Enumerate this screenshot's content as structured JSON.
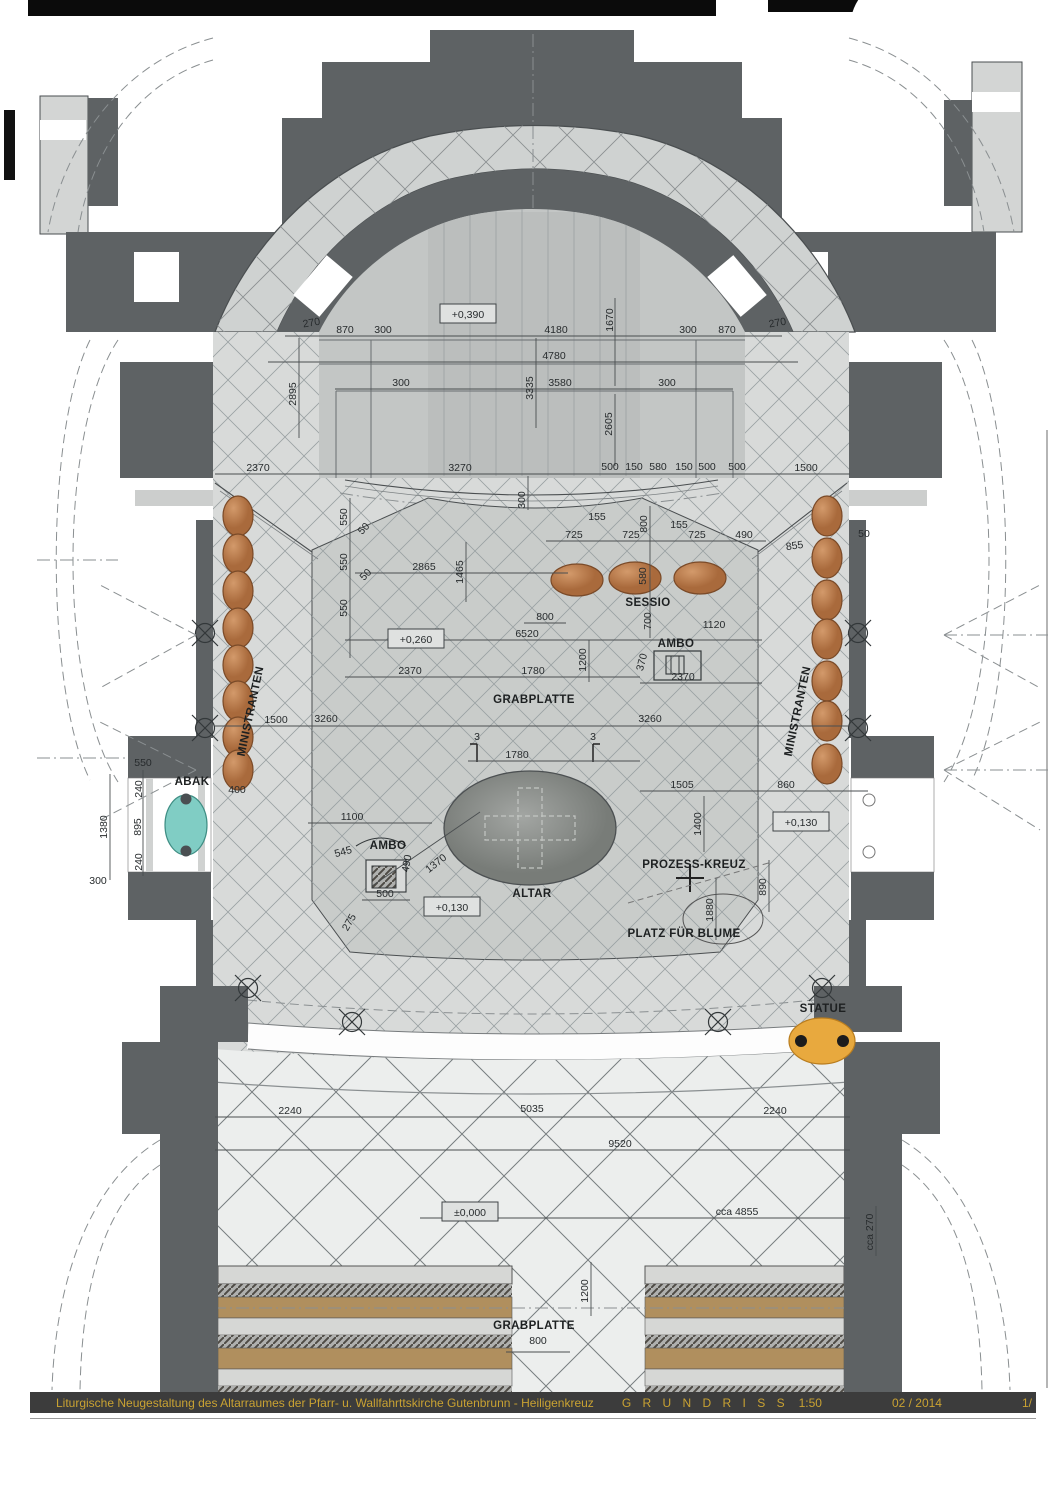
{
  "title_bar": {
    "project": "Liturgische Neugestaltung des Altarraumes der Pfarr- u. Wallfahrttskirche Gutenbrunn - Heiligenkreuz",
    "drawing": "G R U N D R I S S",
    "scale": "1:50",
    "date": "02 / 2014",
    "page": "1/"
  },
  "colors": {
    "wall": "#5e6264",
    "floor": "#d8dad9",
    "floor_nave": "#eceeed",
    "platform": "#c9ccca",
    "apse_floor": "#c3c6c5",
    "band": "#cfd2d1",
    "grid_line": "#9aa1a3",
    "seat": "#c08456",
    "seat_dark": "#7a4a28",
    "abak": "#80cdc4",
    "statue": "#e8a93e",
    "altar": "#8d908d",
    "pew_wood": "#b08f5e",
    "pew_light": "#d6d7d5",
    "pew_hatch": "#b0b1af",
    "title_bg": "#3c3c3c",
    "title_text": "#c9a232",
    "dash": "#8a8f91",
    "line": "#4a4e50"
  },
  "feature_labels": [
    {
      "t": "MINISTRANTEN",
      "x": 254,
      "y": 712,
      "r": -78
    },
    {
      "t": "MINISTRANTEN",
      "x": 801,
      "y": 712,
      "r": -78
    },
    {
      "t": "SESSIO",
      "x": 648,
      "y": 606
    },
    {
      "t": "AMBO",
      "x": 676,
      "y": 647
    },
    {
      "t": "AMBO",
      "x": 388,
      "y": 849
    },
    {
      "t": "GRABPLATTE",
      "x": 534,
      "y": 703
    },
    {
      "t": "ALTAR",
      "x": 532,
      "y": 897
    },
    {
      "t": "PROZESS-KREUZ",
      "x": 694,
      "y": 868
    },
    {
      "t": "PLATZ FÜR BLUME",
      "x": 684,
      "y": 937
    },
    {
      "t": "ABAK",
      "x": 192,
      "y": 785
    },
    {
      "t": "STATUE",
      "x": 823,
      "y": 1012
    },
    {
      "t": "GRABPLATTE",
      "x": 534,
      "y": 1329
    }
  ],
  "elevations": [
    {
      "t": "+0,390",
      "x": 468,
      "y": 314
    },
    {
      "t": "+0,260",
      "x": 416,
      "y": 639
    },
    {
      "t": "+0,130",
      "x": 452,
      "y": 907
    },
    {
      "t": "+0,130",
      "x": 801,
      "y": 822
    },
    {
      "t": "±0,000",
      "x": 470,
      "y": 1212
    }
  ],
  "dimensions": [
    {
      "t": "270",
      "x": 312,
      "y": 326,
      "r": -10
    },
    {
      "t": "870",
      "x": 345,
      "y": 333
    },
    {
      "t": "300",
      "x": 383,
      "y": 333
    },
    {
      "t": "4180",
      "x": 556,
      "y": 333
    },
    {
      "t": "1670",
      "x": 613,
      "y": 320,
      "r": -90
    },
    {
      "t": "300",
      "x": 688,
      "y": 333
    },
    {
      "t": "870",
      "x": 727,
      "y": 333
    },
    {
      "t": "270",
      "x": 778,
      "y": 326,
      "r": -10
    },
    {
      "t": "4780",
      "x": 554,
      "y": 359
    },
    {
      "t": "2895",
      "x": 296,
      "y": 394,
      "r": -90
    },
    {
      "t": "3335",
      "x": 533,
      "y": 388,
      "r": -90
    },
    {
      "t": "3580",
      "x": 560,
      "y": 386
    },
    {
      "t": "300",
      "x": 401,
      "y": 386
    },
    {
      "t": "300",
      "x": 667,
      "y": 386
    },
    {
      "t": "2605",
      "x": 612,
      "y": 424,
      "r": -90
    },
    {
      "t": "2370",
      "x": 258,
      "y": 471
    },
    {
      "t": "3270",
      "x": 460,
      "y": 471
    },
    {
      "t": "500",
      "x": 610,
      "y": 470
    },
    {
      "t": "150",
      "x": 634,
      "y": 470
    },
    {
      "t": "580",
      "x": 658,
      "y": 470
    },
    {
      "t": "150",
      "x": 684,
      "y": 470
    },
    {
      "t": "500",
      "x": 707,
      "y": 470
    },
    {
      "t": "500",
      "x": 737,
      "y": 470
    },
    {
      "t": "1500",
      "x": 806,
      "y": 471
    },
    {
      "t": "300",
      "x": 525,
      "y": 500,
      "r": -90
    },
    {
      "t": "550",
      "x": 347,
      "y": 517,
      "r": -90
    },
    {
      "t": "50",
      "x": 366,
      "y": 531,
      "r": -45
    },
    {
      "t": "550",
      "x": 347,
      "y": 562,
      "r": -90
    },
    {
      "t": "50",
      "x": 368,
      "y": 577,
      "r": -45
    },
    {
      "t": "550",
      "x": 347,
      "y": 608,
      "r": -90
    },
    {
      "t": "2865",
      "x": 424,
      "y": 570
    },
    {
      "t": "1500",
      "x": 276,
      "y": 723
    },
    {
      "t": "400",
      "x": 237,
      "y": 793
    },
    {
      "t": "155",
      "x": 597,
      "y": 520
    },
    {
      "t": "725",
      "x": 574,
      "y": 538
    },
    {
      "t": "725",
      "x": 631,
      "y": 538
    },
    {
      "t": "155",
      "x": 679,
      "y": 528
    },
    {
      "t": "725",
      "x": 697,
      "y": 538
    },
    {
      "t": "490",
      "x": 744,
      "y": 538
    },
    {
      "t": "855",
      "x": 795,
      "y": 549,
      "r": -8
    },
    {
      "t": "50",
      "x": 864,
      "y": 537
    },
    {
      "t": "1465",
      "x": 463,
      "y": 572,
      "r": -90
    },
    {
      "t": "800",
      "x": 647,
      "y": 524,
      "r": -90
    },
    {
      "t": "580",
      "x": 646,
      "y": 576,
      "r": -90
    },
    {
      "t": "700",
      "x": 651,
      "y": 621,
      "r": -90
    },
    {
      "t": "800",
      "x": 545,
      "y": 620
    },
    {
      "t": "6520",
      "x": 527,
      "y": 637
    },
    {
      "t": "1200",
      "x": 586,
      "y": 660,
      "r": -90
    },
    {
      "t": "1120",
      "x": 714,
      "y": 628
    },
    {
      "t": "370",
      "x": 645,
      "y": 663,
      "r": -75
    },
    {
      "t": "2370",
      "x": 410,
      "y": 674
    },
    {
      "t": "1780",
      "x": 533,
      "y": 674
    },
    {
      "t": "2370",
      "x": 683,
      "y": 680
    },
    {
      "t": "3260",
      "x": 326,
      "y": 722
    },
    {
      "t": "3260",
      "x": 650,
      "y": 722
    },
    {
      "t": "3",
      "x": 477,
      "y": 740
    },
    {
      "t": "1780",
      "x": 517,
      "y": 758
    },
    {
      "t": "3",
      "x": 593,
      "y": 740
    },
    {
      "t": "1505",
      "x": 682,
      "y": 788
    },
    {
      "t": "860",
      "x": 786,
      "y": 788
    },
    {
      "t": "1400",
      "x": 701,
      "y": 824,
      "r": -90
    },
    {
      "t": "1880",
      "x": 713,
      "y": 910,
      "r": -90
    },
    {
      "t": "890",
      "x": 766,
      "y": 887,
      "r": -90
    },
    {
      "t": "1100",
      "x": 352,
      "y": 820
    },
    {
      "t": "545",
      "x": 344,
      "y": 855,
      "r": -15
    },
    {
      "t": "490",
      "x": 410,
      "y": 864,
      "r": -80
    },
    {
      "t": "1370",
      "x": 438,
      "y": 866,
      "r": -38
    },
    {
      "t": "500",
      "x": 385,
      "y": 897
    },
    {
      "t": "275",
      "x": 352,
      "y": 924,
      "r": -60
    },
    {
      "t": "550",
      "x": 143,
      "y": 766
    },
    {
      "t": "240",
      "x": 142,
      "y": 789,
      "r": -90
    },
    {
      "t": "895",
      "x": 141,
      "y": 827,
      "r": -90
    },
    {
      "t": "240",
      "x": 142,
      "y": 862,
      "r": -90
    },
    {
      "t": "1380",
      "x": 107,
      "y": 827,
      "r": -90
    },
    {
      "t": "300",
      "x": 98,
      "y": 884
    },
    {
      "t": "2240",
      "x": 290,
      "y": 1114
    },
    {
      "t": "5035",
      "x": 532,
      "y": 1112
    },
    {
      "t": "2240",
      "x": 775,
      "y": 1114
    },
    {
      "t": "9520",
      "x": 620,
      "y": 1147
    },
    {
      "t": "cca 4855",
      "x": 737,
      "y": 1215
    },
    {
      "t": "cca 270",
      "x": 873,
      "y": 1232,
      "r": -90
    },
    {
      "t": "1200",
      "x": 588,
      "y": 1291,
      "r": -90
    },
    {
      "t": "800",
      "x": 538,
      "y": 1344
    }
  ]
}
